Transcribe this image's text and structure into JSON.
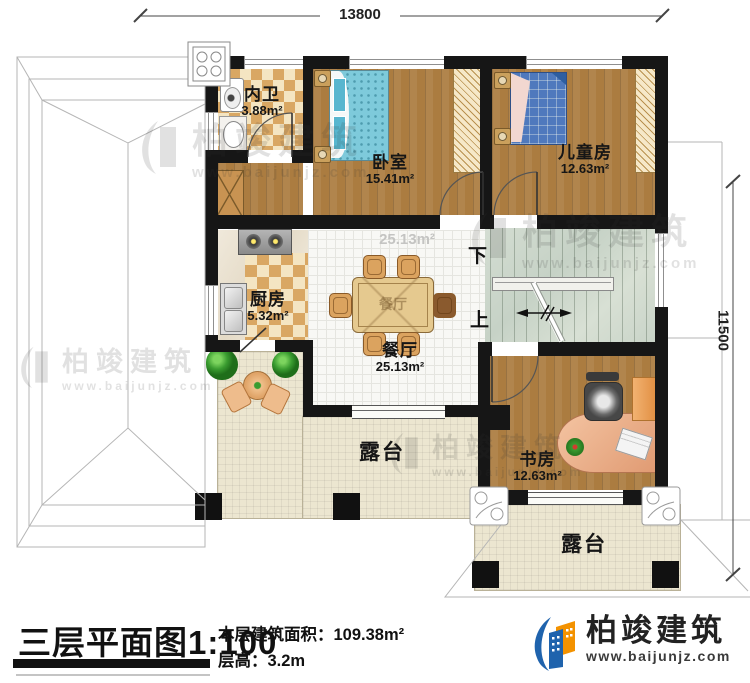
{
  "dimensions": {
    "width_mm": "13800",
    "height_mm": "11500"
  },
  "rooms": {
    "neiwei": {
      "name": "内卫",
      "area": "3.88m²"
    },
    "woshi": {
      "name": "卧室",
      "area": "15.41m²"
    },
    "ertongfang": {
      "name": "儿童房",
      "area": "12.63m²"
    },
    "chufang": {
      "name": "厨房",
      "area": "5.32m²"
    },
    "canting": {
      "name": "餐厅",
      "area": "25.13m²",
      "area_ghost": "25.13m²"
    },
    "shufang": {
      "name": "书房",
      "area": "12.63m²"
    },
    "lutai_left": {
      "name": "露台"
    },
    "lutai_bottom": {
      "name": "露台"
    }
  },
  "stairs": {
    "down_label": "下",
    "up_label": "上"
  },
  "table_label": "餐厅",
  "watermark": {
    "brand": "柏竣建筑",
    "url": "www.baijunjz.com"
  },
  "title_block": {
    "title": "三层平面图",
    "scale": "1:100",
    "area_label": "本层建筑面积：",
    "area_value": "109.38m²",
    "floor_height_label": "层高：",
    "floor_height_value": "3.2m"
  },
  "logo": {
    "brand": "柏竣建筑",
    "url": "www.baijunjz.com"
  },
  "colors": {
    "wall": "#161616",
    "wood": "#ab7c40",
    "accent_blue": "#1f63ad",
    "accent_orange": "#f39200"
  }
}
